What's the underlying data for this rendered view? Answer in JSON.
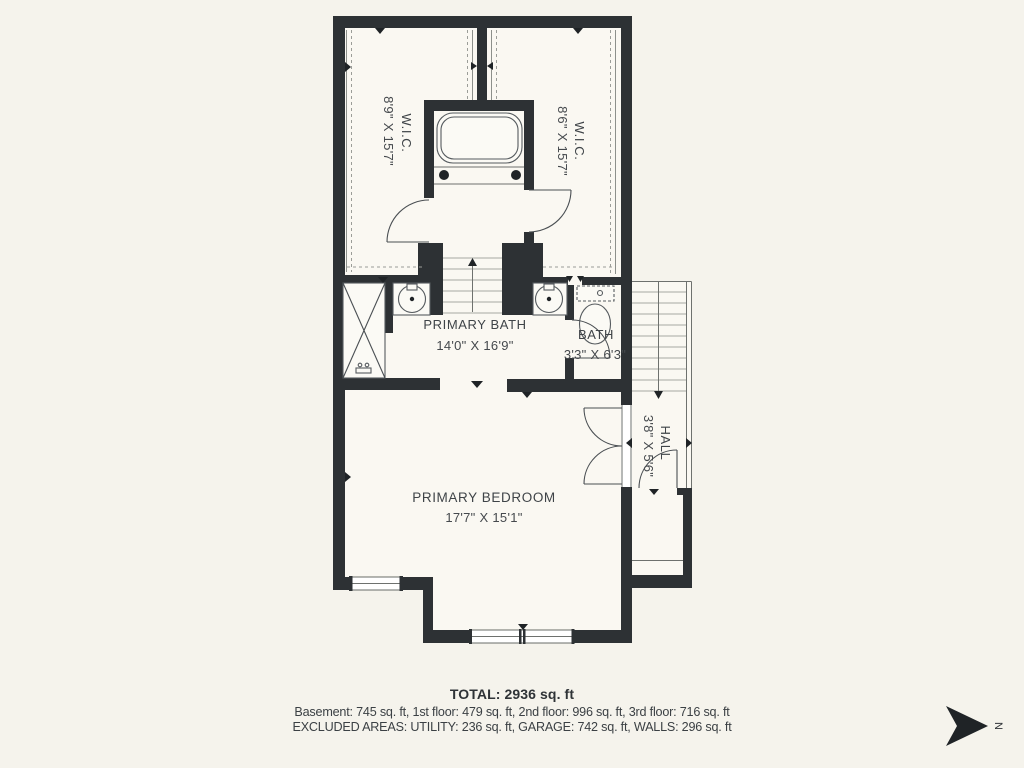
{
  "rooms": {
    "wic_left": {
      "label": "W.I.C.",
      "dims": "8'9\" X 15'7\""
    },
    "wic_right": {
      "label": "W.I.C.",
      "dims": "8'6\" X 15'7\""
    },
    "primary_bath": {
      "label": "PRIMARY BATH",
      "dims": "14'0\" X 16'9\""
    },
    "bath": {
      "label": "BATH",
      "dims": "3'3\" X 6'3\""
    },
    "hall": {
      "label": "HALL",
      "dims": "3'8\" X 5'6\""
    },
    "primary_bedroom": {
      "label": "PRIMARY BEDROOM",
      "dims": "17'7\" X 15'1\""
    }
  },
  "summary": {
    "total": "TOTAL: 2936 sq. ft",
    "floors": "Basement: 745 sq. ft, 1st floor: 479 sq. ft, 2nd floor: 996 sq. ft, 3rd floor: 716 sq. ft",
    "excluded": "EXCLUDED AREAS: UTILITY: 236 sq. ft, GARAGE: 742 sq. ft, WALLS: 296 sq. ft"
  },
  "compass": {
    "north_label": "N"
  },
  "colors": {
    "background": "#f5f3ec",
    "floor": "#faf8f2",
    "wall": "#2d3134",
    "text": "#3f4448"
  }
}
